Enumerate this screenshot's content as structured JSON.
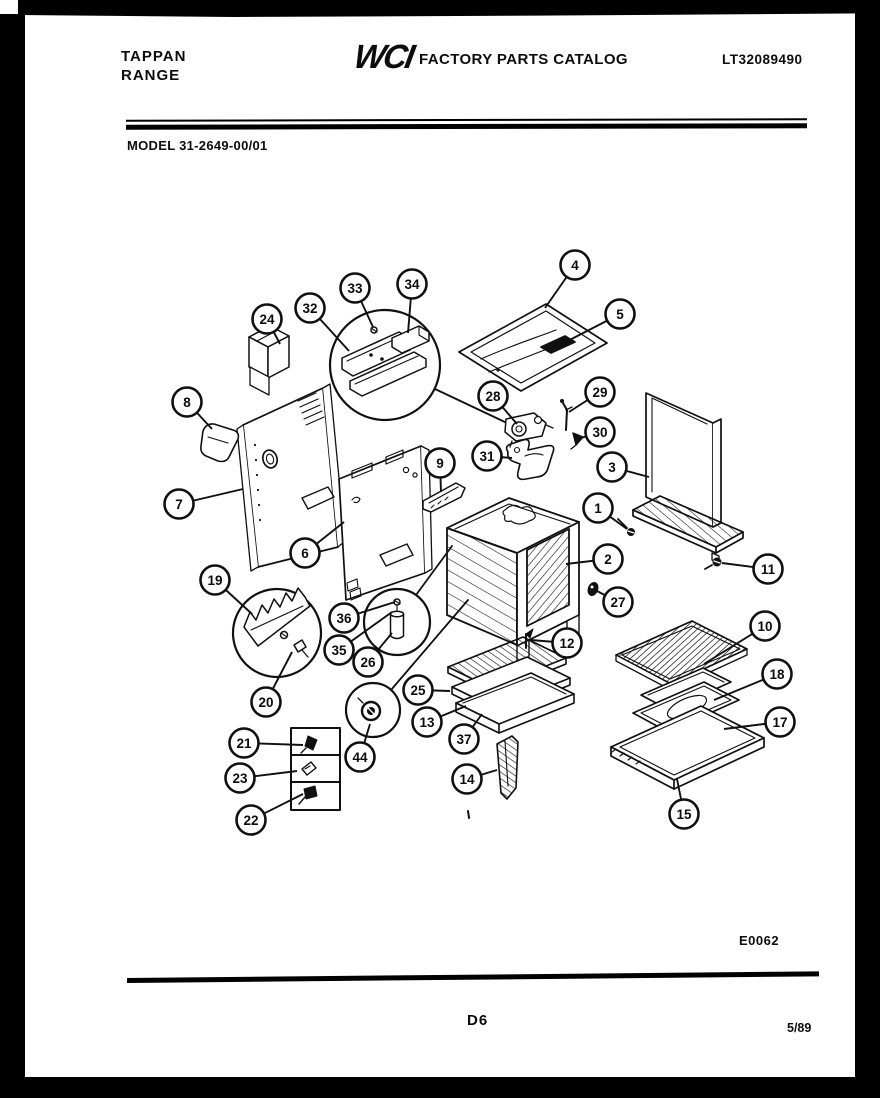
{
  "page": {
    "brand_line1": "TAPPAN",
    "brand_line2": "RANGE",
    "logo_text": "WCI",
    "catalog_title": "FACTORY PARTS CATALOG",
    "publication_number": "LT32089490",
    "model_label": "MODEL 31-2649-00/01",
    "figure_code": "E0062",
    "page_code": "D6",
    "revision_date": "5/89"
  },
  "diagram": {
    "title": "Range body exploded parts view",
    "callouts": [
      {
        "label": "1",
        "cx": 598,
        "cy": 508,
        "tx": 627,
        "ty": 529
      },
      {
        "label": "2",
        "cx": 608,
        "cy": 559,
        "tx": 566,
        "ty": 564
      },
      {
        "label": "3",
        "cx": 612,
        "cy": 467,
        "tx": 649,
        "ty": 477
      },
      {
        "label": "4",
        "cx": 575,
        "cy": 265,
        "tx": 545,
        "ty": 308
      },
      {
        "label": "5",
        "cx": 620,
        "cy": 314,
        "tx": 558,
        "ty": 346
      },
      {
        "label": "6",
        "cx": 305,
        "cy": 553,
        "tx": 344,
        "ty": 522
      },
      {
        "label": "7",
        "cx": 179,
        "cy": 504,
        "tx": 243,
        "ty": 489
      },
      {
        "label": "8",
        "cx": 187,
        "cy": 402,
        "tx": 212,
        "ty": 429
      },
      {
        "label": "9",
        "cx": 440,
        "cy": 463,
        "tx": 441,
        "ty": 492
      },
      {
        "label": "10",
        "cx": 765,
        "cy": 626,
        "tx": 704,
        "ty": 664
      },
      {
        "label": "11",
        "cx": 768,
        "cy": 569,
        "tx": 722,
        "ty": 563
      },
      {
        "label": "12",
        "cx": 567,
        "cy": 643,
        "tx": 531,
        "ty": 640
      },
      {
        "label": "13",
        "cx": 427,
        "cy": 722,
        "tx": 466,
        "ty": 706
      },
      {
        "label": "14",
        "cx": 467,
        "cy": 779,
        "tx": 497,
        "ty": 770
      },
      {
        "label": "15",
        "cx": 684,
        "cy": 814,
        "tx": 677,
        "ty": 779
      },
      {
        "label": "17",
        "cx": 780,
        "cy": 722,
        "tx": 724,
        "ty": 729
      },
      {
        "label": "18",
        "cx": 777,
        "cy": 674,
        "tx": 714,
        "ty": 700
      },
      {
        "label": "19",
        "cx": 215,
        "cy": 580,
        "tx": 252,
        "ty": 614
      },
      {
        "label": "20",
        "cx": 266,
        "cy": 702,
        "tx": 292,
        "ty": 652
      },
      {
        "label": "21",
        "cx": 244,
        "cy": 743,
        "tx": 303,
        "ty": 745
      },
      {
        "label": "22",
        "cx": 251,
        "cy": 820,
        "tx": 303,
        "ty": 794
      },
      {
        "label": "23",
        "cx": 240,
        "cy": 778,
        "tx": 297,
        "ty": 771
      },
      {
        "label": "24",
        "cx": 267,
        "cy": 319,
        "tx": 280,
        "ty": 344
      },
      {
        "label": "25",
        "cx": 418,
        "cy": 690,
        "tx": 450,
        "ty": 691
      },
      {
        "label": "26",
        "cx": 368,
        "cy": 662,
        "tx": 392,
        "ty": 633
      },
      {
        "label": "27",
        "cx": 618,
        "cy": 602,
        "tx": 597,
        "ty": 591
      },
      {
        "label": "28",
        "cx": 493,
        "cy": 396,
        "tx": 517,
        "ty": 424
      },
      {
        "label": "29",
        "cx": 600,
        "cy": 392,
        "tx": 569,
        "ty": 412
      },
      {
        "label": "30",
        "cx": 600,
        "cy": 432,
        "tx": 581,
        "ty": 438
      },
      {
        "label": "31",
        "cx": 487,
        "cy": 456,
        "tx": 512,
        "ty": 458
      },
      {
        "label": "32",
        "cx": 310,
        "cy": 308,
        "tx": 349,
        "ty": 351
      },
      {
        "label": "33",
        "cx": 355,
        "cy": 288,
        "tx": 373,
        "ty": 327
      },
      {
        "label": "34",
        "cx": 412,
        "cy": 284,
        "tx": 408,
        "ty": 333
      },
      {
        "label": "35",
        "cx": 339,
        "cy": 650,
        "tx": 392,
        "ty": 612
      },
      {
        "label": "36",
        "cx": 344,
        "cy": 618,
        "tx": 395,
        "ty": 602
      },
      {
        "label": "37",
        "cx": 464,
        "cy": 739,
        "tx": 482,
        "ty": 714
      },
      {
        "label": "44",
        "cx": 360,
        "cy": 757,
        "tx": 370,
        "ty": 724
      }
    ]
  },
  "colors": {
    "ink": "#101010",
    "paper": "#ffffff"
  }
}
